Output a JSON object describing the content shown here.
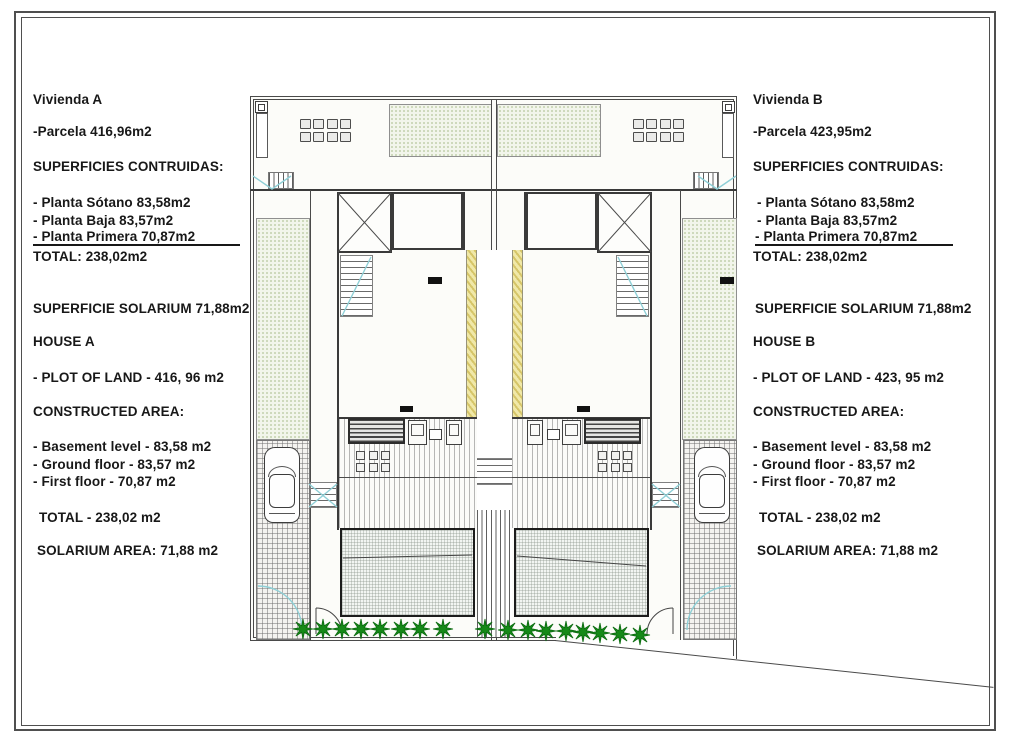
{
  "document": {
    "type_label": "semi-detached villas site plan",
    "line_color": "#4a4a4a",
    "party_wall_color": "#e9dc8e",
    "accent_blue": "#8ecfd6",
    "vegetation_color": "#168a18"
  },
  "left_panel": {
    "title": "Vivienda A",
    "parcela": "-Parcela 416,96m2",
    "superficies_heading": "SUPERFICIES CONTRUIDAS:",
    "planta_sotano": "- Planta Sótano 83,58m2",
    "planta_baja": "- Planta Baja 83,57m2",
    "planta_primera": "- Planta Primera 70,87m2",
    "total": "TOTAL: 238,02m2",
    "solarium": "SUPERFICIE SOLARIUM 71,88m2",
    "house": "HOUSE A",
    "plot": "- PLOT OF LAND - 416, 96 m2",
    "constructed_heading": "CONSTRUCTED AREA:",
    "basement": "- Basement level - 83,58 m2",
    "ground": "- Ground floor - 83,57 m2",
    "first": "- First floor - 70,87 m2",
    "total_en": "TOTAL - 238,02 m2",
    "solarium_en": "SOLARIUM AREA: 71,88 m2"
  },
  "right_panel": {
    "title": "Vivienda B",
    "parcela": "-Parcela 423,95m2",
    "superficies_heading": "SUPERFICIES CONTRUIDAS:",
    "planta_sotano": "- Planta Sótano 83,58m2",
    "planta_baja": "- Planta Baja 83,57m2",
    "planta_primera": "- Planta Primera 70,87m2",
    "total": "TOTAL: 238,02m2",
    "solarium": "SUPERFICIE SOLARIUM 71,88m2",
    "house": "HOUSE B",
    "plot": "- PLOT OF LAND - 423, 95 m2",
    "constructed_heading": "CONSTRUCTED AREA:",
    "basement": "- Basement level - 83,58 m2",
    "ground": "- Ground floor - 83,57 m2",
    "first": "- First floor - 70,87 m2",
    "total_en": "TOTAL - 238,02 m2",
    "solarium_en": "SOLARIUM AREA: 71,88 m2"
  },
  "plan": {
    "roof_tables": [
      {
        "x": 300,
        "y": 119,
        "cols": 4,
        "rows": 2,
        "cw": 11,
        "ch": 10,
        "dx": 13.4,
        "dy": 12.5
      },
      {
        "x": 633,
        "y": 119,
        "cols": 4,
        "rows": 2,
        "cw": 11,
        "ch": 10,
        "dx": 13.4,
        "dy": 12.5
      }
    ],
    "patio_tables": [
      {
        "x": 356,
        "y": 451,
        "cols": 3,
        "rows": 2,
        "cw": 9,
        "ch": 9,
        "dx": 12.5,
        "dy": 12
      },
      {
        "x": 598,
        "y": 451,
        "cols": 3,
        "rows": 2,
        "cw": 9,
        "ch": 9,
        "dx": 12.5,
        "dy": 12
      }
    ],
    "bushes": {
      "left": [
        [
          303,
          629
        ],
        [
          323,
          629
        ],
        [
          342,
          629
        ],
        [
          361,
          629
        ],
        [
          380,
          629
        ],
        [
          401,
          629
        ],
        [
          420,
          629
        ],
        [
          443,
          629
        ],
        [
          485,
          629
        ]
      ],
      "right": [
        [
          508,
          630
        ],
        [
          528,
          630
        ],
        [
          546,
          631
        ],
        [
          566,
          631
        ],
        [
          583,
          632
        ],
        [
          600,
          633
        ],
        [
          620,
          634
        ],
        [
          640,
          635
        ]
      ]
    }
  }
}
